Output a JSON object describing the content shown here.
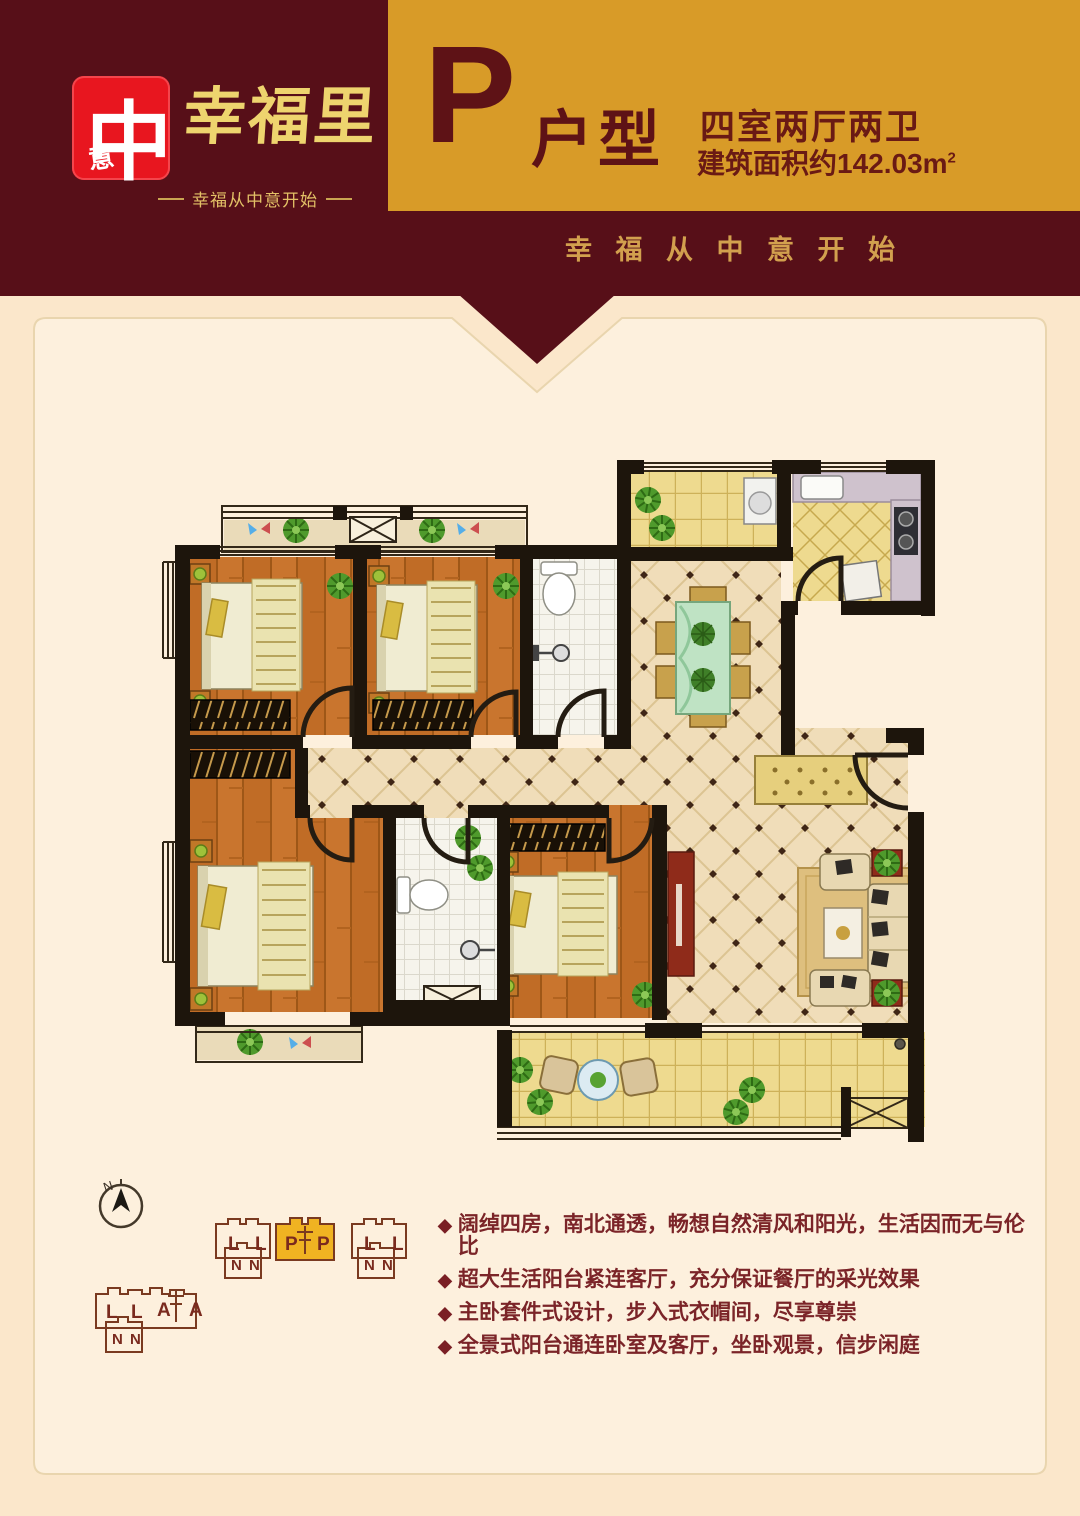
{
  "page": {
    "bg": "#fbe7cb",
    "panel_bg": "#fdf0dd",
    "panel_border": "#e9d5ae"
  },
  "header": {
    "bg": "#570f18",
    "gold": "#d89b28",
    "logo": {
      "seal_main": "中",
      "seal_sub": "意",
      "brand": "幸福里",
      "slogan": "幸福从中意开始"
    },
    "unit": {
      "letter": "P",
      "type_label": "户型",
      "rooms": "四室两厅两卫",
      "area": "建筑面积约142.03m",
      "area_sup": "2"
    },
    "banner_tagline": "幸 福 从 中 意 开 始"
  },
  "features": {
    "bullet": "◆",
    "items": [
      "阔绰四房，南北通透，畅想自然清风和阳光，生活因而无与伦比",
      "超大生活阳台紧连客厅，充分保证餐厅的采光效果",
      "主卧套件式设计，步入式衣帽间，尽享尊崇",
      "全景式阳台通连卧室及客厅，坐卧观景，信步闲庭"
    ]
  },
  "siteplan": {
    "compass_label": "N",
    "highlight": "#f0b322",
    "row1_left": [
      "L",
      "L"
    ],
    "row1_center": [
      "P",
      "P"
    ],
    "row1_right": [
      "L",
      "L"
    ],
    "row1_sub_left": [
      "N",
      "N"
    ],
    "row1_sub_right": [
      "N",
      "N"
    ],
    "row2": [
      "L",
      "L",
      "A",
      "A"
    ],
    "row2_sub": [
      "N",
      "N"
    ]
  }
}
